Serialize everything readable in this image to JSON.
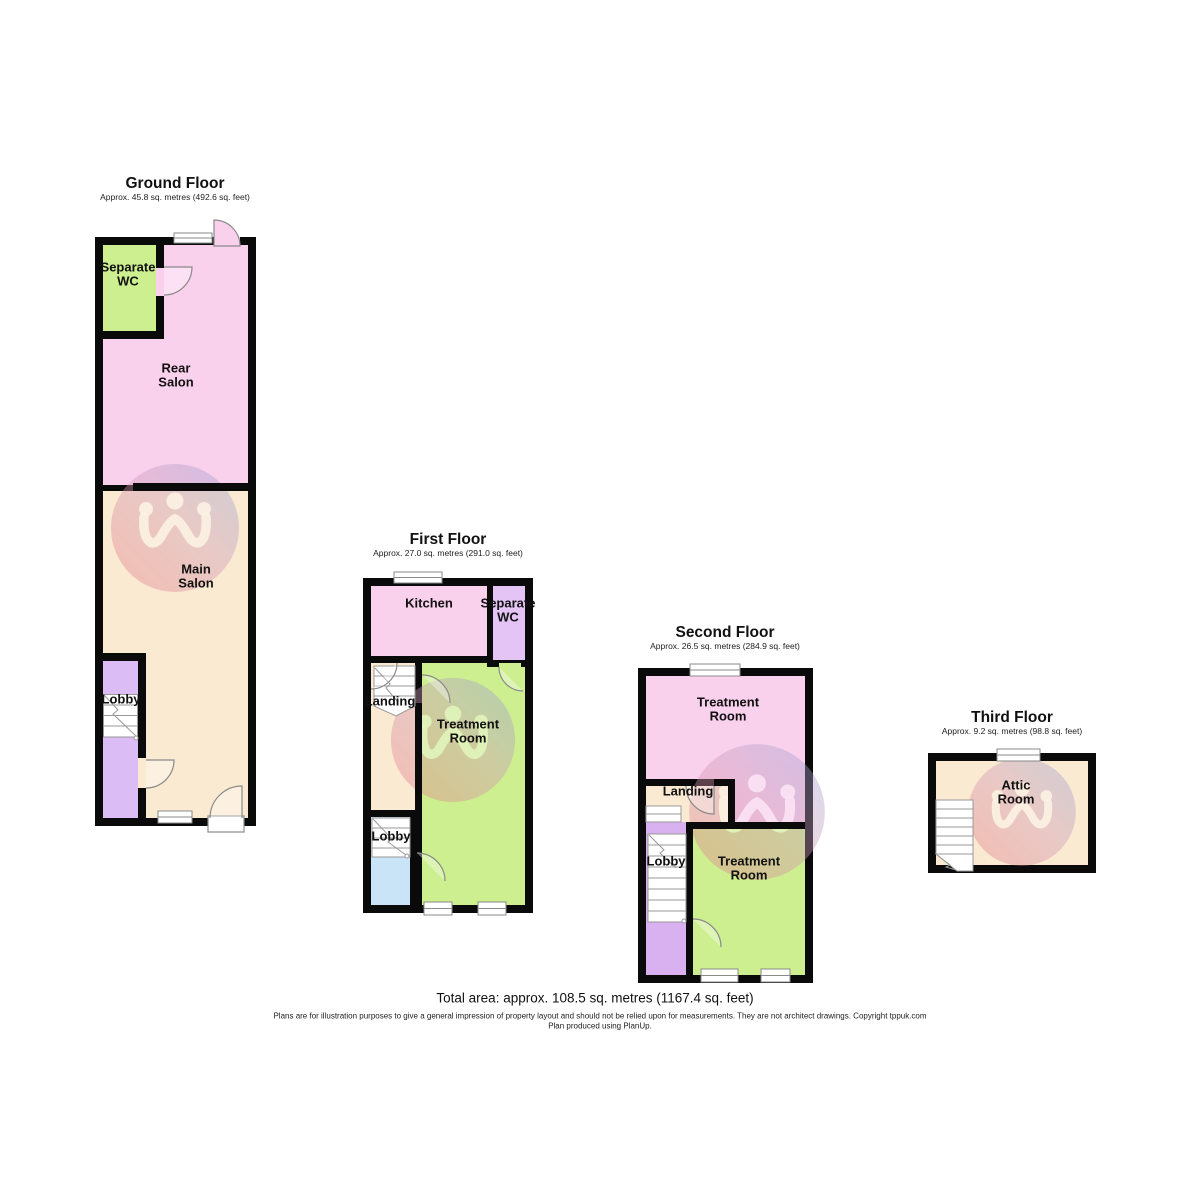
{
  "palette": {
    "wall": "#0a0a0a",
    "room_pink": "#f9d1ed",
    "room_green": "#cdef90",
    "room_cream": "#faead1",
    "room_lavender": "#dcbcf4",
    "room_purple_wc": "#e3c4f4",
    "room_blue": "#c9e3f7",
    "room_lobby_purple": "#d9b0f0",
    "door_window_stroke": "#8a8a8a",
    "watermark_red": "#ea7a84",
    "watermark_blue": "#8fa3d8"
  },
  "floors": [
    {
      "title": "Ground Floor",
      "subtitle": "Approx. 45.8 sq. metres (492.6 sq. feet)",
      "rooms": [
        {
          "label": "Separate WC"
        },
        {
          "label": "Rear Salon"
        },
        {
          "label": "Main Salon"
        },
        {
          "label": "Lobby"
        }
      ]
    },
    {
      "title": "First Floor",
      "subtitle": "Approx. 27.0 sq. metres (291.0 sq. feet)",
      "rooms": [
        {
          "label": "Kitchen"
        },
        {
          "label": "Separate WC"
        },
        {
          "label": "Landing"
        },
        {
          "label": "Treatment Room"
        },
        {
          "label": "Lobby"
        }
      ]
    },
    {
      "title": "Second Floor",
      "subtitle": "Approx. 26.5 sq. metres (284.9 sq. feet)",
      "rooms": [
        {
          "label": "Treatment Room"
        },
        {
          "label": "Landing"
        },
        {
          "label": "Lobby"
        },
        {
          "label": "Treatment Room"
        }
      ]
    },
    {
      "title": "Third Floor",
      "subtitle": "Approx. 9.2 sq. metres (98.8 sq. feet)",
      "rooms": [
        {
          "label": "Attic Room"
        }
      ]
    }
  ],
  "footer": {
    "total_area": "Total area: approx. 108.5 sq. metres (1167.4 sq. feet)",
    "disclaimer": "Plans are for illustration purposes to give a general impression of property layout and should not be relied upon for measurements. They are not architect drawings.  Copyright tppuk.com",
    "produced_by": "Plan produced using PlanUp."
  }
}
